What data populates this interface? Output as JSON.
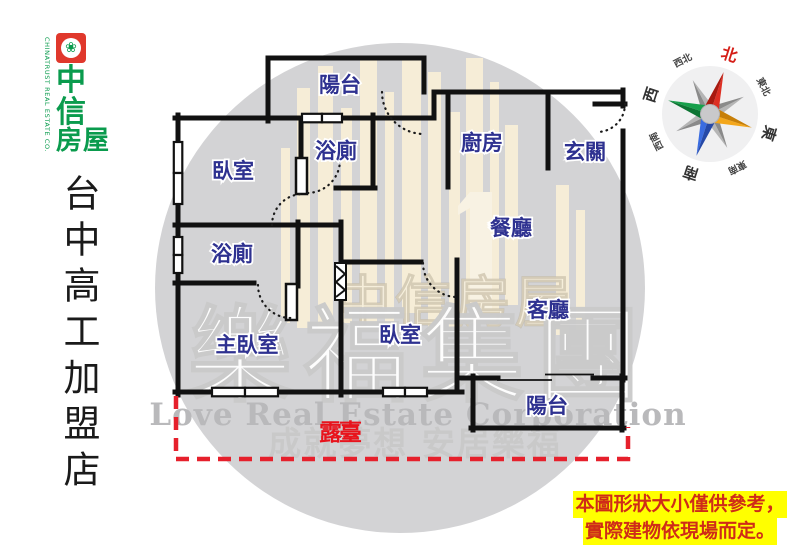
{
  "brand": {
    "logo_rows": [
      "中",
      "信",
      "房屋"
    ],
    "company_en": "CHINATRUST REAL ESTATE CO.",
    "store_name": "台中高工加盟店",
    "green": "#0a9b4d",
    "logo_red": "#e0382c"
  },
  "compass": {
    "north": "北",
    "northeast": "東北",
    "east": "東",
    "southeast": "東南",
    "south": "南",
    "southwest": "西南",
    "west": "西",
    "northwest": "西北"
  },
  "floorplan": {
    "wall_color": "#111111",
    "label_color": "#2e3190",
    "rooms": [
      {
        "id": "balcony-top",
        "label": "陽台"
      },
      {
        "id": "bedroom-1",
        "label": "臥室"
      },
      {
        "id": "bath-1",
        "label": "浴廁"
      },
      {
        "id": "kitchen",
        "label": "廚房"
      },
      {
        "id": "foyer",
        "label": "玄關"
      },
      {
        "id": "dining",
        "label": "餐廳"
      },
      {
        "id": "bath-2",
        "label": "浴廁"
      },
      {
        "id": "master-bedroom",
        "label": "主臥室"
      },
      {
        "id": "bedroom-2",
        "label": "臥室"
      },
      {
        "id": "living-room",
        "label": "客廳"
      },
      {
        "id": "balcony-bottom",
        "label": "陽台"
      }
    ],
    "terrace": {
      "label": "露臺",
      "color": "#e8131c",
      "dash_color": "#e6202c"
    }
  },
  "watermark": {
    "brand_faint": "中信房屋",
    "group_name": "樂福集團",
    "company_en": "Love Real Estate Corporation",
    "slogan": "成就夢想 安居樂福"
  },
  "disclaimer": {
    "line1": "本圖形狀大小僅供參考，",
    "line2": "實際建物依現場而定。",
    "bg": "#ffff00",
    "color": "#cf2c18"
  }
}
